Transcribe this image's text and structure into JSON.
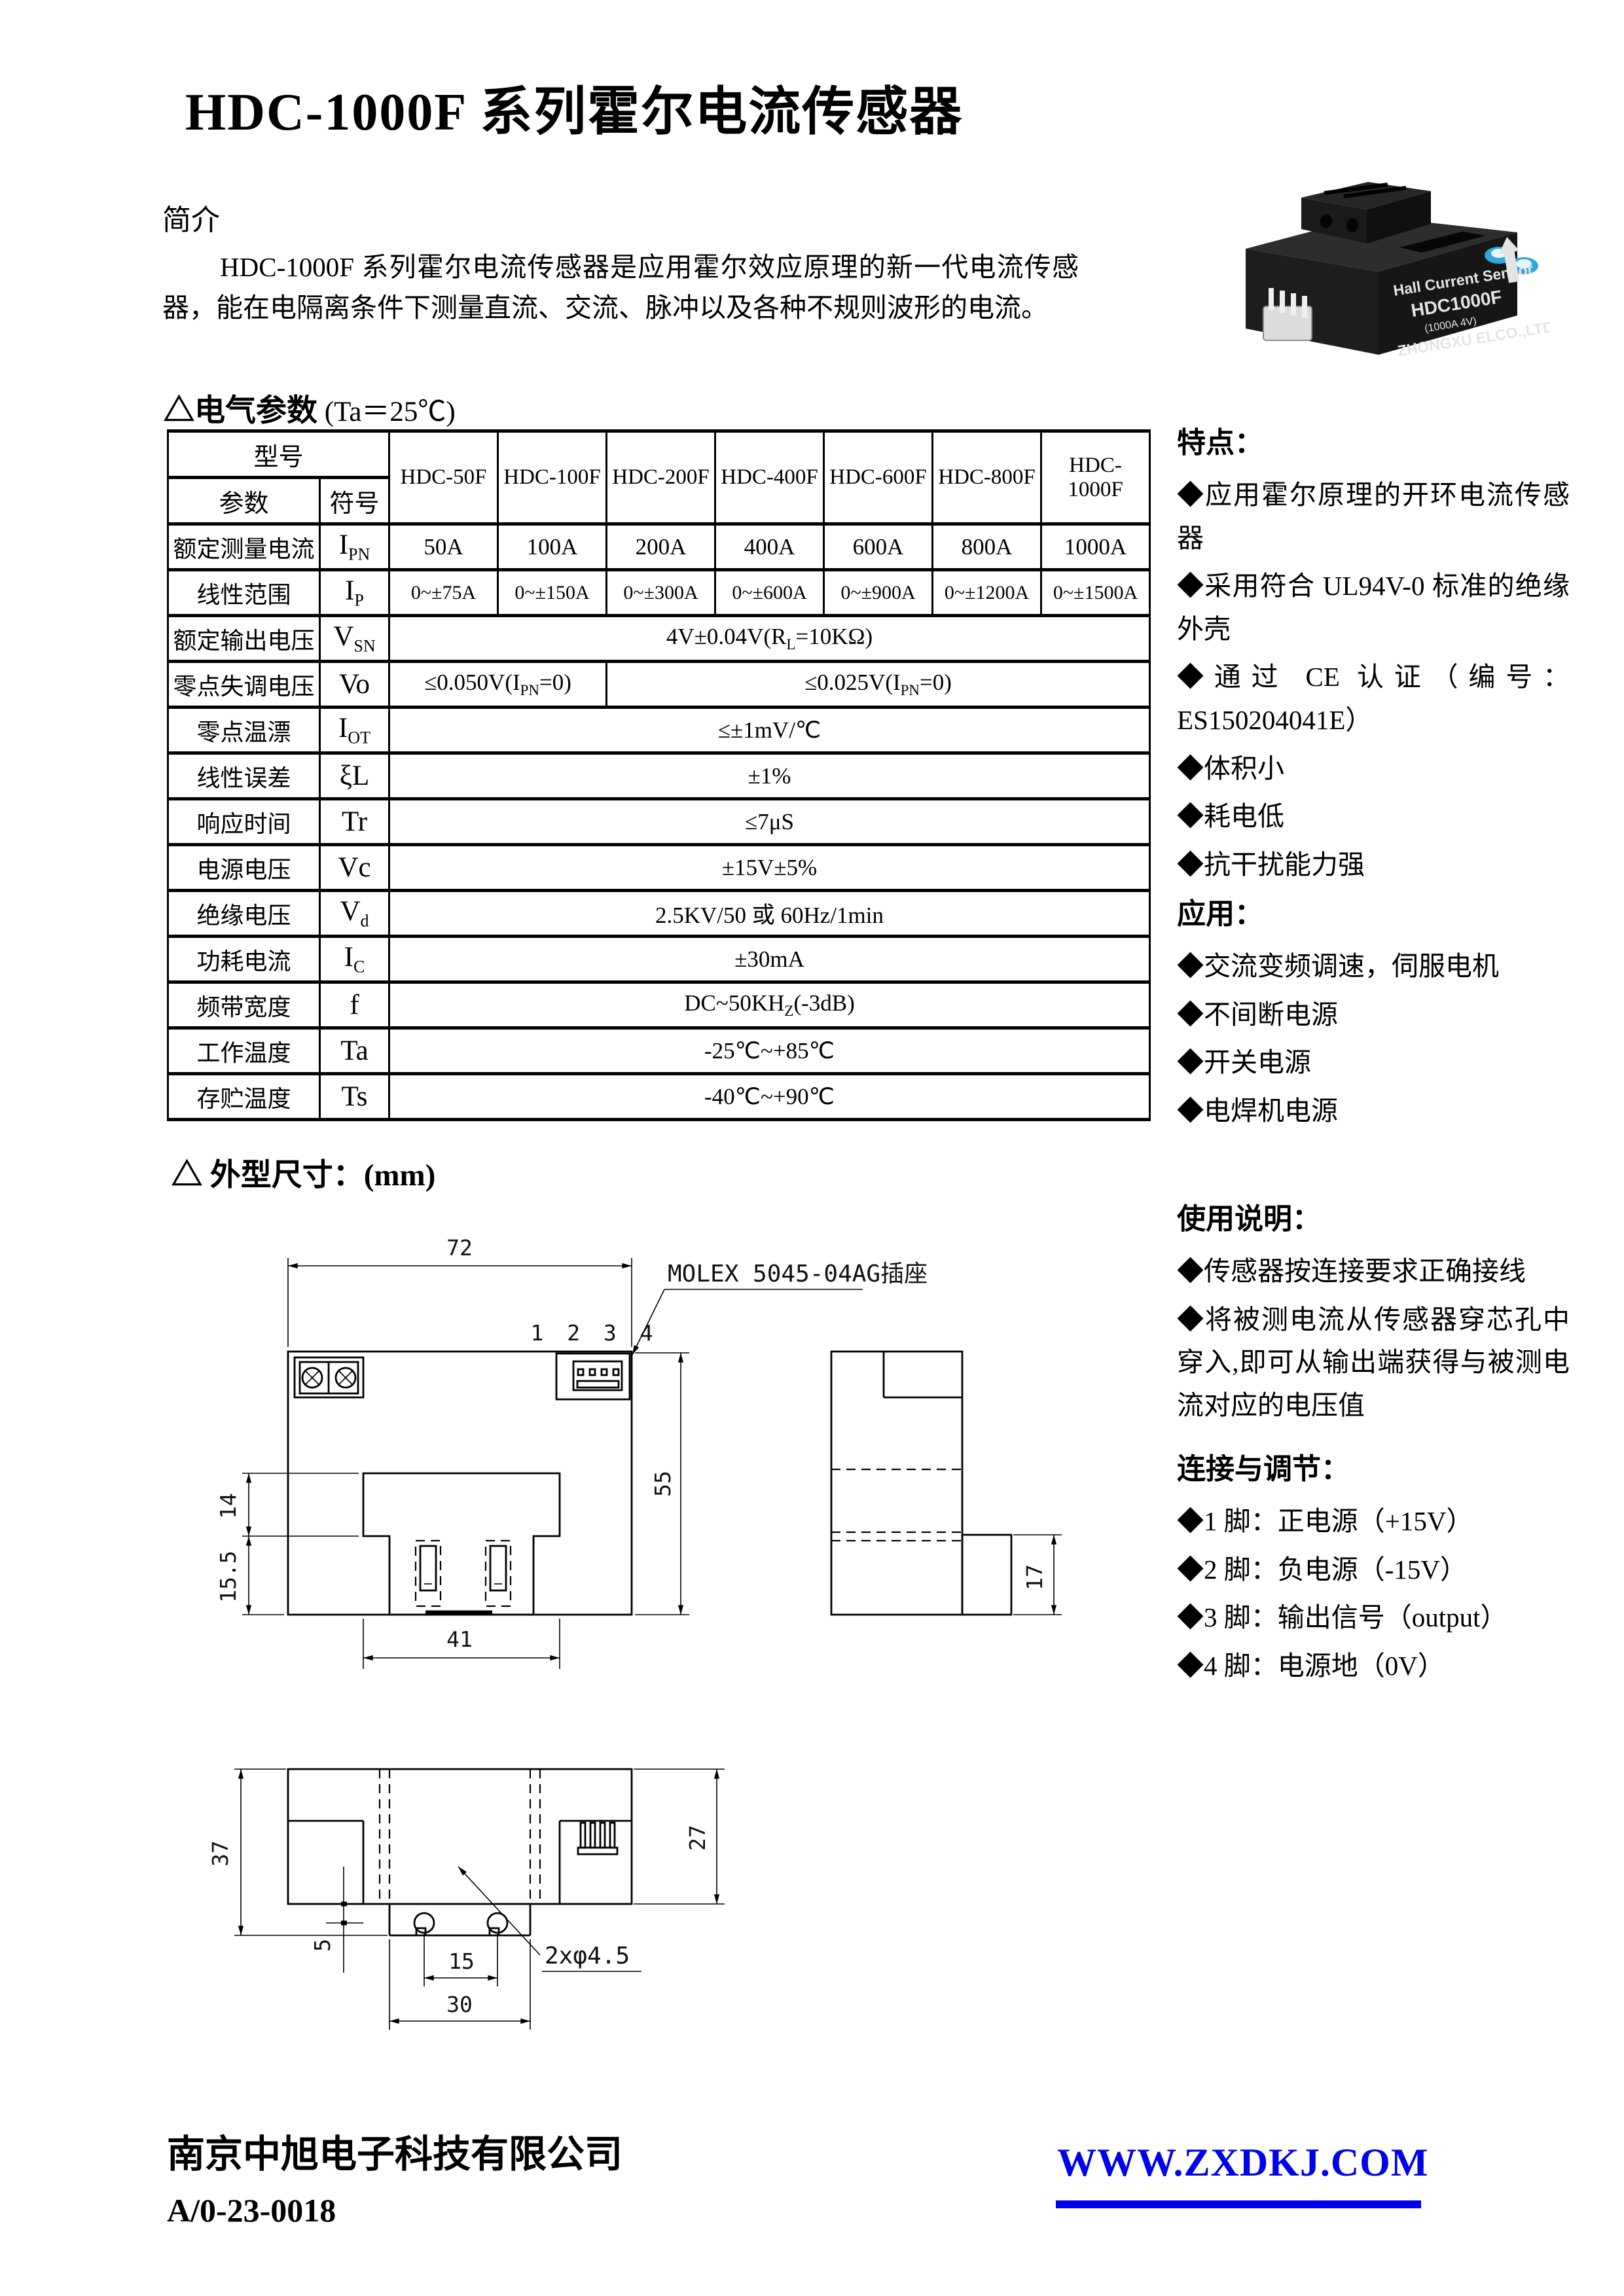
{
  "page_title": "HDC-1000F 系列霍尔电流传感器",
  "intro": {
    "heading": "简介",
    "body": "HDC-1000F 系列霍尔电流传感器是应用霍尔效应原理的新一代电流传感器，能在电隔离条件下测量直流、交流、脉冲以及各种不规则波形的电流。"
  },
  "product_photo": {
    "line1": "Hall Current Sensor",
    "line2": "HDC1000F",
    "line3": "(1000A 4V)",
    "line4": "ZHONGXU ELCO.,LTD"
  },
  "elec": {
    "heading": "△电气参数",
    "heading_cond": " (Ta＝25℃)",
    "table": {
      "corner_top": "型号",
      "corner_param": "参数",
      "corner_symbol": "符号",
      "models": [
        "HDC-50F",
        "HDC-100F",
        "HDC-200F",
        "HDC-400F",
        "HDC-600F",
        "HDC-800F",
        "HDC-1000F"
      ],
      "rows": [
        {
          "label": "额定测量电流",
          "sym": "I",
          "sub": "PN",
          "values": [
            "50A",
            "100A",
            "200A",
            "400A",
            "600A",
            "800A",
            "1000A"
          ]
        },
        {
          "label": "线性范围",
          "sym": "I",
          "sub": "P",
          "values": [
            "0~±75A",
            "0~±150A",
            "0~±300A",
            "0~±600A",
            "0~±900A",
            "0~±1200A",
            "0~±1500A"
          ]
        },
        {
          "label": "额定输出电压",
          "sym": "V",
          "sub": "SN",
          "value": {
            "pre": "4V±0.04V(R",
            "sub": "L",
            "post": "=10KΩ)"
          }
        },
        {
          "label": "零点失调电压",
          "sym": "Vo",
          "sub": "",
          "value_a": {
            "pre": "≤0.050V(I",
            "sub": "PN",
            "post": "=0)"
          },
          "value_b": {
            "pre": "≤0.025V(I",
            "sub": "PN",
            "post": "=0)"
          }
        },
        {
          "label": "零点温漂",
          "sym": "I",
          "sub": "OT",
          "value": "≤±1mV/℃"
        },
        {
          "label": "线性误差",
          "sym": "ξL",
          "sub": "",
          "value": "±1%"
        },
        {
          "label": "响应时间",
          "sym": "Tr",
          "sub": "",
          "value": "≤7μS"
        },
        {
          "label": "电源电压",
          "sym": "Vc",
          "sub": "",
          "value": "±15V±5%"
        },
        {
          "label": "绝缘电压",
          "sym": "V",
          "sub": "d",
          "value": "2.5KV/50 或 60Hz/1min"
        },
        {
          "label": "功耗电流",
          "sym": "I",
          "sub": "C",
          "value": "±30mA"
        },
        {
          "label": "频带宽度",
          "sym": "f",
          "sub": "",
          "value": {
            "pre": "DC~50KH",
            "sub": "Z",
            "post": "(-3dB)"
          }
        },
        {
          "label": "工作温度",
          "sym": "Ta",
          "sub": "",
          "value": "-25℃~+85℃"
        },
        {
          "label": "存贮温度",
          "sym": "Ts",
          "sub": "",
          "value": "-40℃~+90℃"
        }
      ]
    }
  },
  "sidebar": {
    "features": {
      "heading": "特点：",
      "items": [
        "◆应用霍尔原理的开环电流传感器",
        "◆采用符合 UL94V-0 标准的绝缘外壳",
        "◆通过 CE 认证（编号：ES150204041E）",
        "◆体积小",
        "◆耗电低",
        "◆抗干扰能力强"
      ]
    },
    "apps": {
      "heading": "应用：",
      "items": [
        "◆交流变频调速，伺服电机",
        "◆不间断电源",
        "◆开关电源",
        "◆电焊机电源"
      ]
    },
    "usage": {
      "heading": "使用说明：",
      "items": [
        "◆传感器按连接要求正确接线",
        "◆将被测电流从传感器穿芯孔中穿入,即可从输出端获得与被测电流对应的电压值"
      ]
    },
    "conn": {
      "heading": "连接与调节：",
      "items": [
        "◆1 脚：正电源（+15V）",
        "◆2 脚：负电源（-15V）",
        "◆3 脚：输出信号（output）",
        "◆4 脚：电源地（0V）"
      ]
    }
  },
  "dims": {
    "heading": "△ 外型尺寸：",
    "heading_unit": "(mm)",
    "labels": {
      "w72": "72",
      "h55": "55",
      "d14": "14",
      "d155": "15.5",
      "d41": "41",
      "d17": "17",
      "d37": "37",
      "d27": "27",
      "d5": "5",
      "d15": "15",
      "d30": "30",
      "holes": "2xφ4.5",
      "molex": "MOLEX 5045-04AG插座",
      "pins": "1 2 3 4"
    }
  },
  "footer": {
    "company": "南京中旭电子科技有限公司",
    "doc_no": "A/0-23-0018",
    "website": "WWW.ZXDKJ.COM",
    "link_color": "#0000EE"
  }
}
